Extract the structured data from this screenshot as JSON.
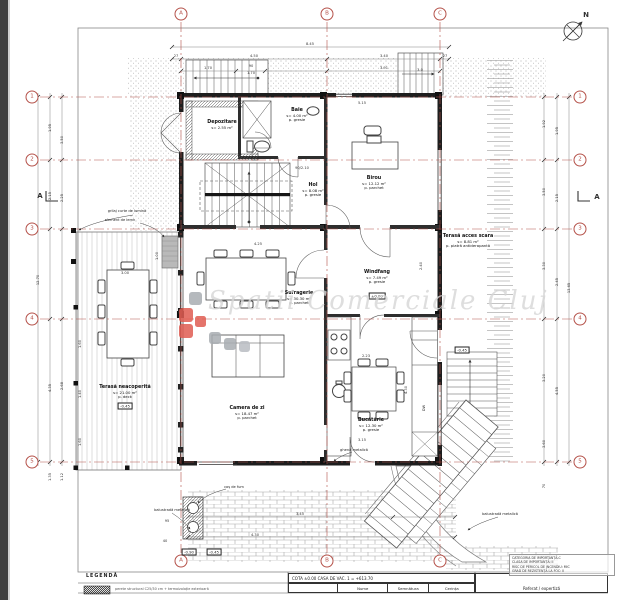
{
  "colors": {
    "axis_red": "#b5524a",
    "logo_red": "#e05c52",
    "logo_gray": "#a9adb2",
    "watermark_gray": "#d6d6d6",
    "wall_dark": "#1e1e1e"
  },
  "sheet": {
    "watermark_text": "Spatii Comerciale Cluj",
    "legend_title": "LEGENDĂ",
    "legend_note": "perete structural C25/30 cm + termoizolație exterioară",
    "cota_line": "COTA ±0.00 CASA DE VAC. 1 = +613.70",
    "sign_cols": [
      "Nume",
      "Semnătura",
      "Cerința"
    ],
    "referat": "Referat / expertiză",
    "importance_lines": [
      "CATEGORIA DE IMPORTANȚĂ-C",
      "CLASA DE IMPORTANȚĂ: II",
      "RISC DE PERICOL DE INCENDIU: MIC",
      "GRAD DE REZISTENȚĂ LA FOC: II"
    ]
  },
  "axes": {
    "letters": [
      {
        "label": "A",
        "x": 181
      },
      {
        "label": "B",
        "x": 327
      },
      {
        "label": "C",
        "x": 440
      }
    ],
    "numbers": [
      {
        "label": "1",
        "y": 97
      },
      {
        "label": "2",
        "y": 160
      },
      {
        "label": "3",
        "y": 229
      },
      {
        "label": "4",
        "y": 319
      },
      {
        "label": "5",
        "y": 462
      }
    ]
  },
  "rooms": [
    {
      "name": "Depozitare",
      "area": "s= 2.55 m²",
      "x": 222,
      "y": 120
    },
    {
      "name": "Baie",
      "area": "s= 4.00 m²",
      "floor": "p. gresie",
      "x": 297,
      "y": 108
    },
    {
      "name": "Birou",
      "area": "s= 12.12 m²",
      "floor": "p. parchet",
      "x": 374,
      "y": 176
    },
    {
      "name": "Hol",
      "area": "s= 8.08 m²",
      "floor": "p. gresie",
      "x": 313,
      "y": 183
    },
    {
      "name": "Windfang",
      "area": "s= 7.49 m²",
      "floor": "p. gresie",
      "x": 377,
      "y": 270
    },
    {
      "name": "Sufragerie",
      "area": "s= 30.30 m²",
      "floor": "p. parchet",
      "x": 299,
      "y": 291
    },
    {
      "name": "Terasă neacoperită",
      "area": "s= 21.00 m²",
      "floor": "p. deck",
      "x": 125,
      "y": 385
    },
    {
      "name": "Camera de zi",
      "area": "s= 18.47 m²",
      "floor": "p. parchet",
      "x": 247,
      "y": 406
    },
    {
      "name": "Bucătărie",
      "area": "s= 12.30 m²",
      "floor": "p. gresie",
      "x": 371,
      "y": 418
    },
    {
      "name": "Terasă acces scara",
      "area": "s= 8.81 m²",
      "floor": "p. piatră antiderapantă",
      "x": 468,
      "y": 234
    }
  ],
  "levels": [
    {
      "t": "±0.00",
      "x": 377,
      "y": 296
    },
    {
      "t": "-0.45",
      "x": 125,
      "y": 406
    },
    {
      "t": "-0.90",
      "x": 189,
      "y": 552
    },
    {
      "t": "-0.45",
      "x": 214,
      "y": 552
    },
    {
      "t": "-0.45",
      "x": 462,
      "y": 350
    }
  ],
  "annotations": [
    {
      "t": "grilaj curte de lumină",
      "x": 127,
      "y": 211
    },
    {
      "t": "element de lemn",
      "x": 120,
      "y": 220
    },
    {
      "t": "balustradă metalică",
      "x": 172,
      "y": 510
    },
    {
      "t": "balustradă metalică",
      "x": 500,
      "y": 514
    },
    {
      "t": "ghenă metalică",
      "x": 354,
      "y": 450
    },
    {
      "t": "coș de fum",
      "x": 234,
      "y": 487
    },
    {
      "t": "DW",
      "x": 424,
      "y": 408,
      "rot": -90
    },
    {
      "t": "A",
      "x": 40,
      "y": 196,
      "cls": "sec"
    },
    {
      "t": "A",
      "x": 597,
      "y": 197,
      "cls": "sec"
    },
    {
      "t": "N",
      "x": 586,
      "y": 15,
      "cls": "sec"
    }
  ],
  "dimensions": [
    {
      "t": "8.45",
      "x": 310,
      "y": 44
    },
    {
      "t": "27",
      "x": 176,
      "y": 56
    },
    {
      "t": "4.50",
      "x": 254,
      "y": 56
    },
    {
      "t": "3.40",
      "x": 384,
      "y": 56
    },
    {
      "t": "27",
      "x": 445,
      "y": 56
    },
    {
      "t": "1.70",
      "x": 208,
      "y": 68
    },
    {
      "t": "90",
      "x": 251,
      "y": 66
    },
    {
      "t": "1.70",
      "x": 251,
      "y": 73
    },
    {
      "t": "3.91",
      "x": 384,
      "y": 68
    },
    {
      "t": "3.0",
      "x": 420,
      "y": 70
    },
    {
      "t": "5.15",
      "x": 362,
      "y": 103
    },
    {
      "t": "90/2.10",
      "x": 302,
      "y": 168
    },
    {
      "t": "4.25",
      "x": 258,
      "y": 244
    },
    {
      "t": "2.40",
      "x": 421,
      "y": 266,
      "rot": -90
    },
    {
      "t": "2.23",
      "x": 366,
      "y": 356
    },
    {
      "t": "3.15",
      "x": 362,
      "y": 440
    },
    {
      "t": "12.70",
      "x": 38,
      "y": 280,
      "rot": -90
    },
    {
      "t": "1.95",
      "x": 50,
      "y": 128,
      "rot": -90
    },
    {
      "t": "3.50",
      "x": 62,
      "y": 140,
      "rot": -90
    },
    {
      "t": "2.15",
      "x": 50,
      "y": 196,
      "rot": -90
    },
    {
      "t": "2.25",
      "x": 62,
      "y": 198,
      "rot": -90
    },
    {
      "t": "4.35",
      "x": 50,
      "y": 388,
      "rot": -90
    },
    {
      "t": "2.68",
      "x": 62,
      "y": 386,
      "rot": -90
    },
    {
      "t": "1.35",
      "x": 50,
      "y": 477,
      "rot": -90
    },
    {
      "t": "1.12",
      "x": 62,
      "y": 477,
      "rot": -90
    },
    {
      "t": "3.00",
      "x": 125,
      "y": 273
    },
    {
      "t": "1.60",
      "x": 80,
      "y": 344,
      "rot": -90
    },
    {
      "t": "1.40",
      "x": 80,
      "y": 394,
      "rot": -90
    },
    {
      "t": "1.60",
      "x": 80,
      "y": 442,
      "rot": -90
    },
    {
      "t": "1.00",
      "x": 157,
      "y": 256,
      "rot": -90
    },
    {
      "t": "1.92",
      "x": 544,
      "y": 124,
      "rot": -90
    },
    {
      "t": "1.95",
      "x": 557,
      "y": 131,
      "rot": -90
    },
    {
      "t": "3.50",
      "x": 544,
      "y": 192,
      "rot": -90
    },
    {
      "t": "2.15",
      "x": 557,
      "y": 198,
      "rot": -90
    },
    {
      "t": "3.30",
      "x": 544,
      "y": 266,
      "rot": -90
    },
    {
      "t": "2.45",
      "x": 557,
      "y": 282,
      "rot": -90
    },
    {
      "t": "13.65",
      "x": 569,
      "y": 288,
      "rot": -90
    },
    {
      "t": "3.20",
      "x": 544,
      "y": 378,
      "rot": -90
    },
    {
      "t": "4.55",
      "x": 557,
      "y": 391,
      "rot": -90
    },
    {
      "t": "3.60",
      "x": 544,
      "y": 444,
      "rot": -90
    },
    {
      "t": "70",
      "x": 544,
      "y": 486,
      "rot": -90
    },
    {
      "t": "4.30",
      "x": 406,
      "y": 390,
      "rot": -90
    },
    {
      "t": "3.45",
      "x": 300,
      "y": 514
    },
    {
      "t": "4.30",
      "x": 255,
      "y": 535
    },
    {
      "t": "95",
      "x": 167,
      "y": 521
    },
    {
      "t": "40",
      "x": 165,
      "y": 541
    }
  ]
}
